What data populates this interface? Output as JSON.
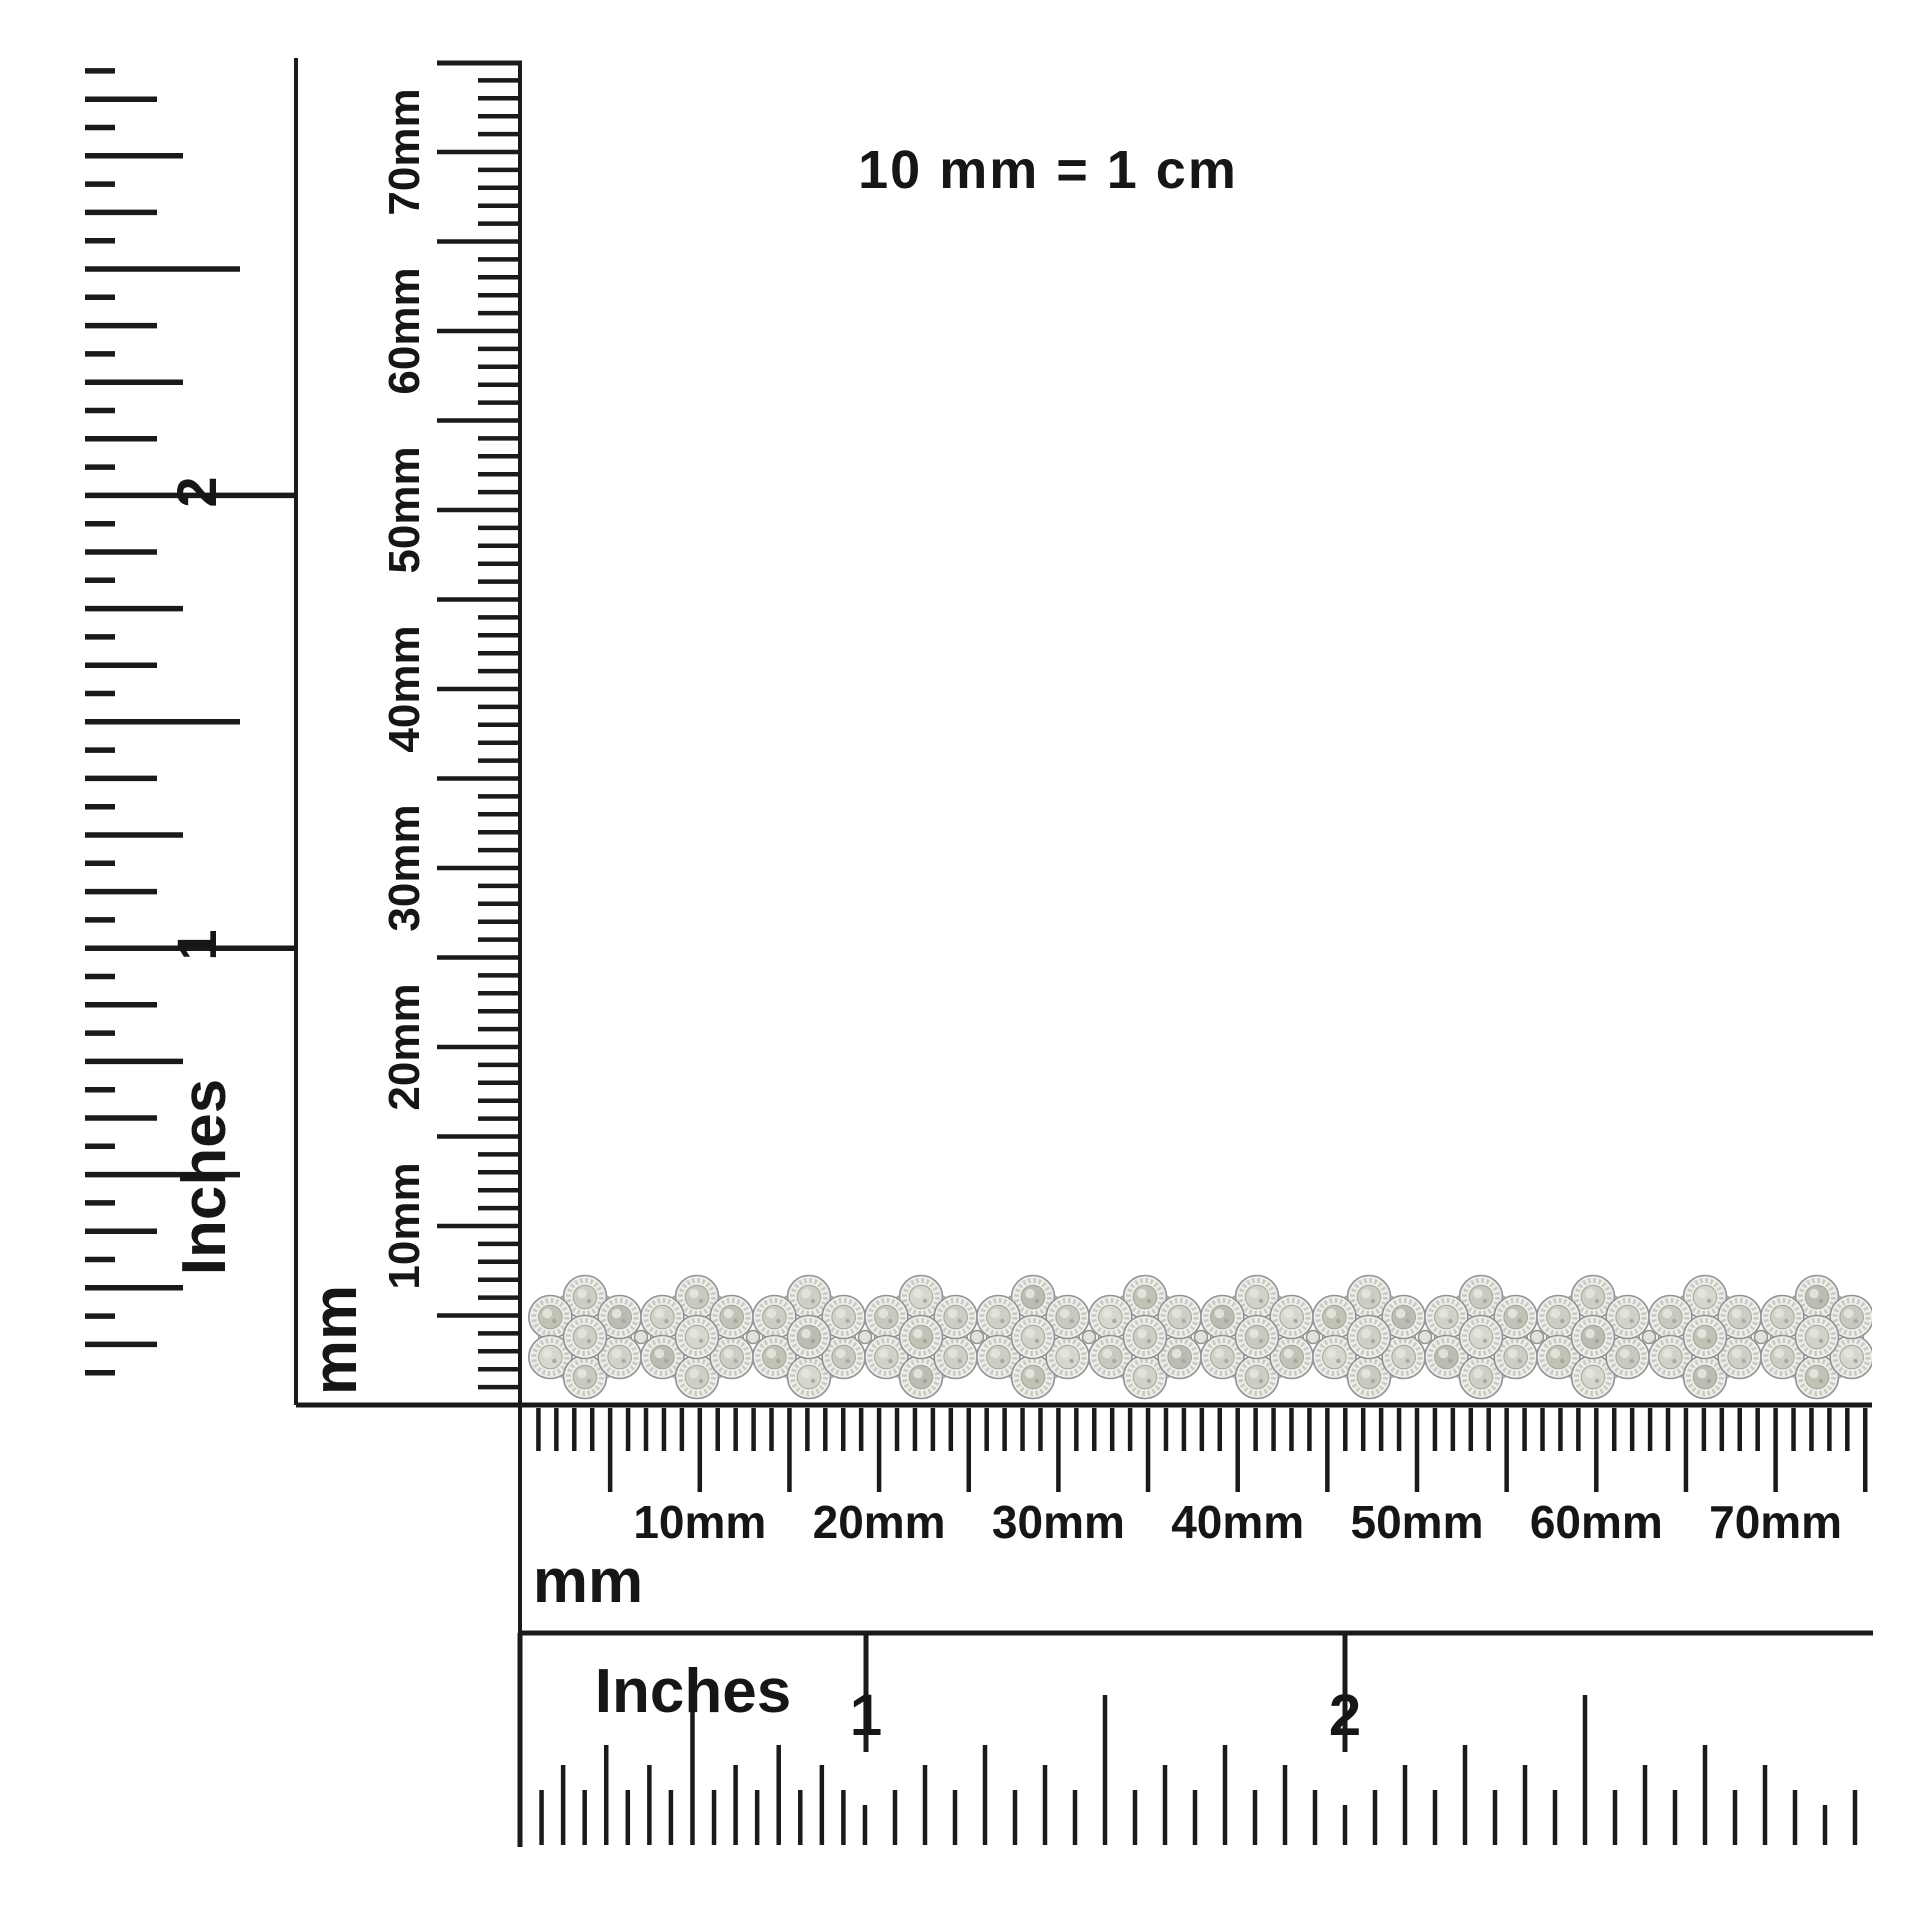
{
  "scale_note": "10 mm = 1 cm",
  "rulers": {
    "vertical_inches": {
      "unit": "Inches",
      "marks": [
        "2",
        "1"
      ],
      "subdivision": "sixteenths"
    },
    "vertical_mm": {
      "unit": "mm",
      "labels": [
        "70mm",
        "60mm",
        "50mm",
        "40mm",
        "30mm",
        "20mm",
        "10mm"
      ]
    },
    "horizontal_mm": {
      "unit": "mm",
      "labels": [
        "10mm",
        "20mm",
        "30mm",
        "40mm",
        "50mm",
        "60mm",
        "70mm"
      ]
    },
    "horizontal_inches": {
      "unit": "Inches",
      "marks": [
        "1",
        "2"
      ],
      "subdivision": "sixteenths"
    }
  },
  "product": {
    "kind": "diamond-flower-cluster-tennis-bracelet",
    "cluster_count": 12,
    "stones_per_cluster": 7,
    "cut_off_at_right_edge": true
  },
  "colors": {
    "ink": "#1a1a1a",
    "background": "#ffffff",
    "stone_shades": [
      "#cdcec3",
      "#c2c3b7",
      "#d6d7cd",
      "#c8c9bf",
      "#d1d2c8",
      "#bcbdb2",
      "#cfd0c5"
    ],
    "stone_rim": "#edeee9",
    "serration": "#c9cbc3",
    "metal_outline": "#8f9594",
    "prong": "#e7e8e3",
    "link": "#dfe1da"
  }
}
